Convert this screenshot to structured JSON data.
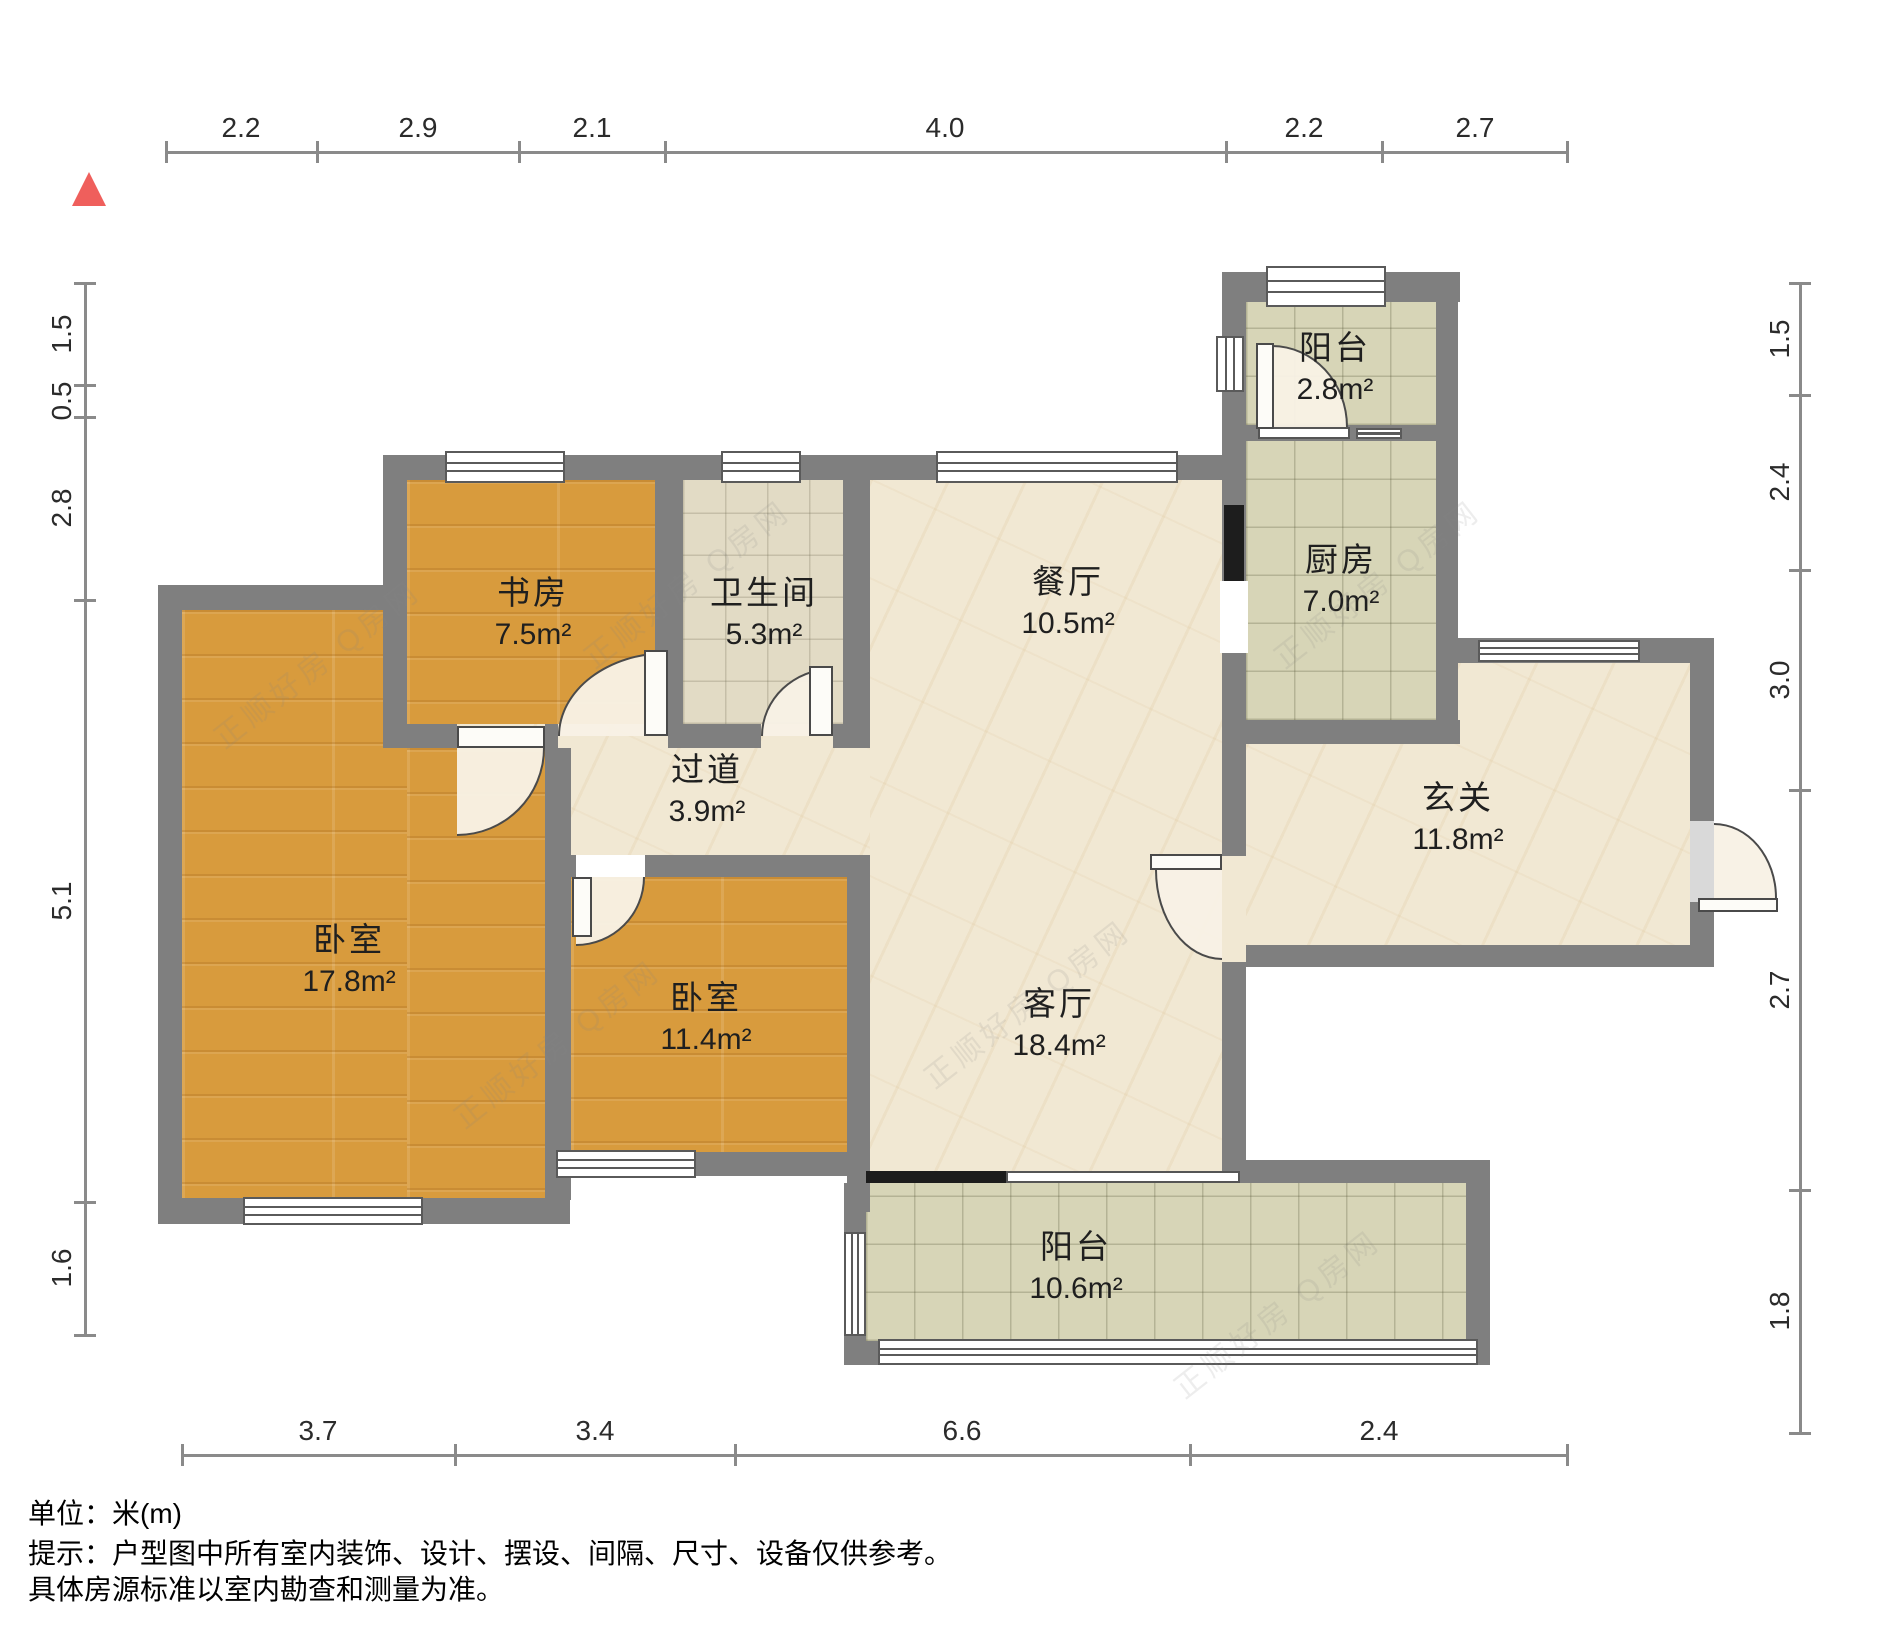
{
  "plan": {
    "type": "residential-floor-plan",
    "unit_label": "单位：米(m)",
    "watermark_text": "正顺好房 Q房网"
  },
  "rooms": [
    {
      "id": "balcony-north",
      "name": "阳台",
      "area": "2.8m²"
    },
    {
      "id": "kitchen",
      "name": "厨房",
      "area": "7.0m²"
    },
    {
      "id": "dining",
      "name": "餐厅",
      "area": "10.5m²"
    },
    {
      "id": "bathroom",
      "name": "卫生间",
      "area": "5.3m²"
    },
    {
      "id": "study",
      "name": "书房",
      "area": "7.5m²"
    },
    {
      "id": "corridor",
      "name": "过道",
      "area": "3.9m²"
    },
    {
      "id": "foyer",
      "name": "玄关",
      "area": "11.8m²"
    },
    {
      "id": "living",
      "name": "客厅",
      "area": "18.4m²"
    },
    {
      "id": "bedroom-large",
      "name": "卧室",
      "area": "17.8m²"
    },
    {
      "id": "bedroom-small",
      "name": "卧室",
      "area": "11.4m²"
    },
    {
      "id": "balcony-south",
      "name": "阳台",
      "area": "10.6m²"
    }
  ],
  "dims": {
    "top": {
      "values": [
        "2.2",
        "2.9",
        "2.1",
        "4.0",
        "2.2",
        "2.7"
      ]
    },
    "left": {
      "values": [
        "1.5",
        "0.5",
        "2.8",
        "5.1",
        "1.6"
      ]
    },
    "right": {
      "values": [
        "1.5",
        "2.4",
        "3.0",
        "2.7",
        "1.8"
      ]
    },
    "bottom": {
      "values": [
        "3.7",
        "3.4",
        "6.6",
        "2.4"
      ]
    }
  },
  "notes": {
    "unit": "单位：米(m)",
    "line1": "提示：户型图中所有室内装饰、设计、摆设、间隔、尺寸、设备仅供参考。",
    "line2": "具体房源标准以室内勘查和测量为准。"
  },
  "colors": {
    "wall": "#7f7f7f",
    "wood_floor": "#d89b3d",
    "marble_floor": "#f1e8d3",
    "tile_floor": "#d7d5b7",
    "bath_floor": "#e2dbc5",
    "north_marker": "#ef5f5c"
  }
}
